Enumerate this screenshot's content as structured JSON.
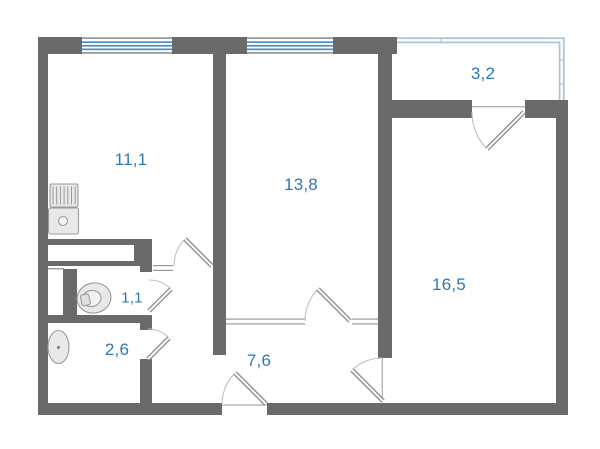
{
  "floor_plan": {
    "rooms": {
      "kitchen": {
        "area": "11,1"
      },
      "living_room": {
        "area": "13,8"
      },
      "balcony": {
        "area": "3,2"
      },
      "bedroom": {
        "area": "16,5"
      },
      "wc": {
        "area": "1,1"
      },
      "bathroom": {
        "area": "2,6"
      },
      "hallway": {
        "area": "7,6"
      }
    },
    "fixtures": [
      "kitchen-sink-unit",
      "toilet",
      "washbasin"
    ],
    "colors": {
      "wall": "#6a6a6a",
      "room_label": "#2e78b8",
      "window_glass": "#4d8fc4",
      "balcony_railing": "#a9c7dc",
      "door_leaf": "#8a8a8a",
      "door_swing_arc": "#bfbfbf",
      "fixture_fill": "#e9e9e9",
      "fixture_outline": "#9a9a9a"
    }
  }
}
